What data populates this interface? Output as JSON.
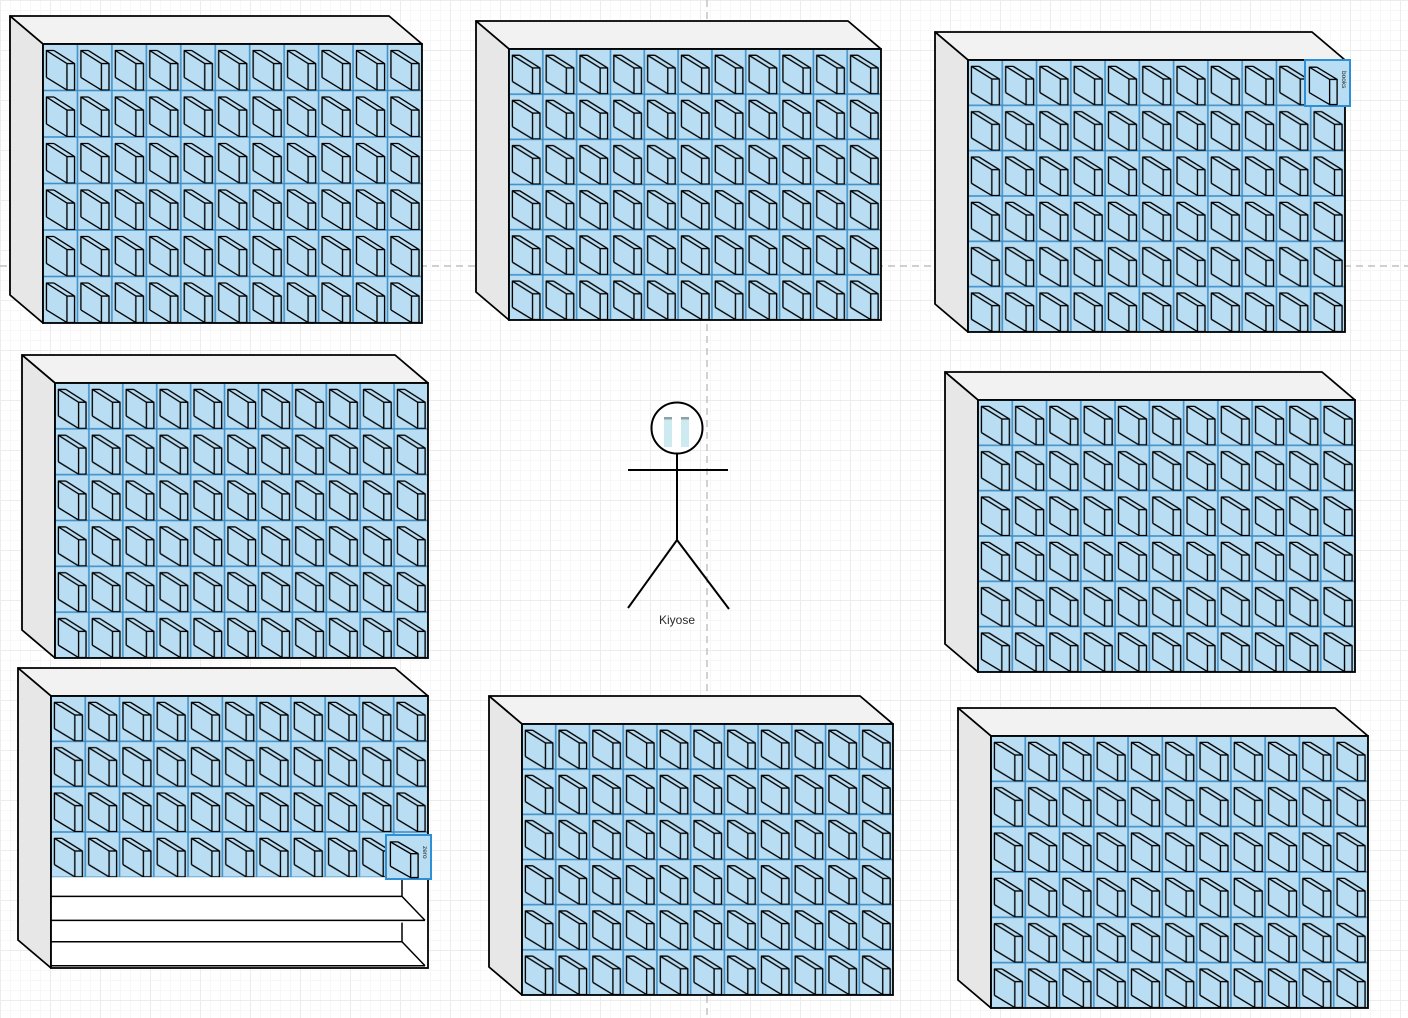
{
  "scene": {
    "title": "bookcase-diagram",
    "width": 1408,
    "height": 1018
  },
  "colors": {
    "background": "#ffffff",
    "grid_minor": "#f7f7f7",
    "grid_major": "#ececec",
    "book_fill": "#b9ddf2",
    "book_border": "#4191c9",
    "line": "#000000",
    "shelf_top": "#f2f2f2",
    "shelf_side": "#e7e7e7",
    "shelf_outline": "#000000",
    "selection_border": "#2e8fd4",
    "guide": "#b4b4b4",
    "figure_bar_fill": "#cdeaf0",
    "figure_bar_cap": "#8fa1a8",
    "label_text": "#2a2a2a"
  },
  "guides": {
    "horizontal_y": 266,
    "vertical_x": 707
  },
  "figure": {
    "label": "Kiyose",
    "head": {
      "cx": 677,
      "cy": 428,
      "r": 25.5
    },
    "bars": [
      {
        "x": 664,
        "y": 417,
        "w": 8,
        "h": 30
      },
      {
        "x": 681,
        "y": 417,
        "w": 8,
        "h": 30
      }
    ],
    "arms": {
      "y": 470,
      "x1": 628,
      "x2": 728
    },
    "torso": {
      "x": 677,
      "y1": 453,
      "y2": 540
    },
    "legs": [
      {
        "x2": 628,
        "y2": 608
      },
      {
        "x2": 729,
        "y2": 609
      }
    ],
    "label_pos": {
      "x": 677,
      "y": 624
    }
  },
  "bookcases": [
    {
      "name": "bookcase-top-left",
      "x": 10,
      "y": 16,
      "w": 412,
      "h": 307,
      "cols": 11,
      "book_rows": 6,
      "empty_rows": 0
    },
    {
      "name": "bookcase-top-center",
      "x": 476,
      "y": 21,
      "w": 405,
      "h": 299,
      "cols": 11,
      "book_rows": 6,
      "empty_rows": 0
    },
    {
      "name": "bookcase-top-right",
      "x": 935,
      "y": 32,
      "w": 410,
      "h": 300,
      "cols": 11,
      "book_rows": 6,
      "empty_rows": 0
    },
    {
      "name": "bookcase-middle-left",
      "x": 22,
      "y": 355,
      "w": 406,
      "h": 303,
      "cols": 11,
      "book_rows": 6,
      "empty_rows": 0
    },
    {
      "name": "bookcase-middle-right",
      "x": 945,
      "y": 372,
      "w": 410,
      "h": 300,
      "cols": 11,
      "book_rows": 6,
      "empty_rows": 0
    },
    {
      "name": "bookcase-bottom-left",
      "x": 18,
      "y": 668,
      "w": 410,
      "h": 300,
      "cols": 11,
      "book_rows": 4,
      "empty_rows": 2
    },
    {
      "name": "bookcase-bottom-center",
      "x": 489,
      "y": 696,
      "w": 404,
      "h": 299,
      "cols": 11,
      "book_rows": 6,
      "empty_rows": 0
    },
    {
      "name": "bookcase-bottom-right",
      "x": 958,
      "y": 708,
      "w": 410,
      "h": 300,
      "cols": 11,
      "book_rows": 6,
      "empty_rows": 0
    }
  ],
  "labeled_books": [
    {
      "label": "books",
      "x": 1305,
      "y": 60,
      "w": 45,
      "h": 46
    },
    {
      "label": "zero",
      "x": 386,
      "y": 835,
      "w": 45,
      "h": 44
    }
  ]
}
